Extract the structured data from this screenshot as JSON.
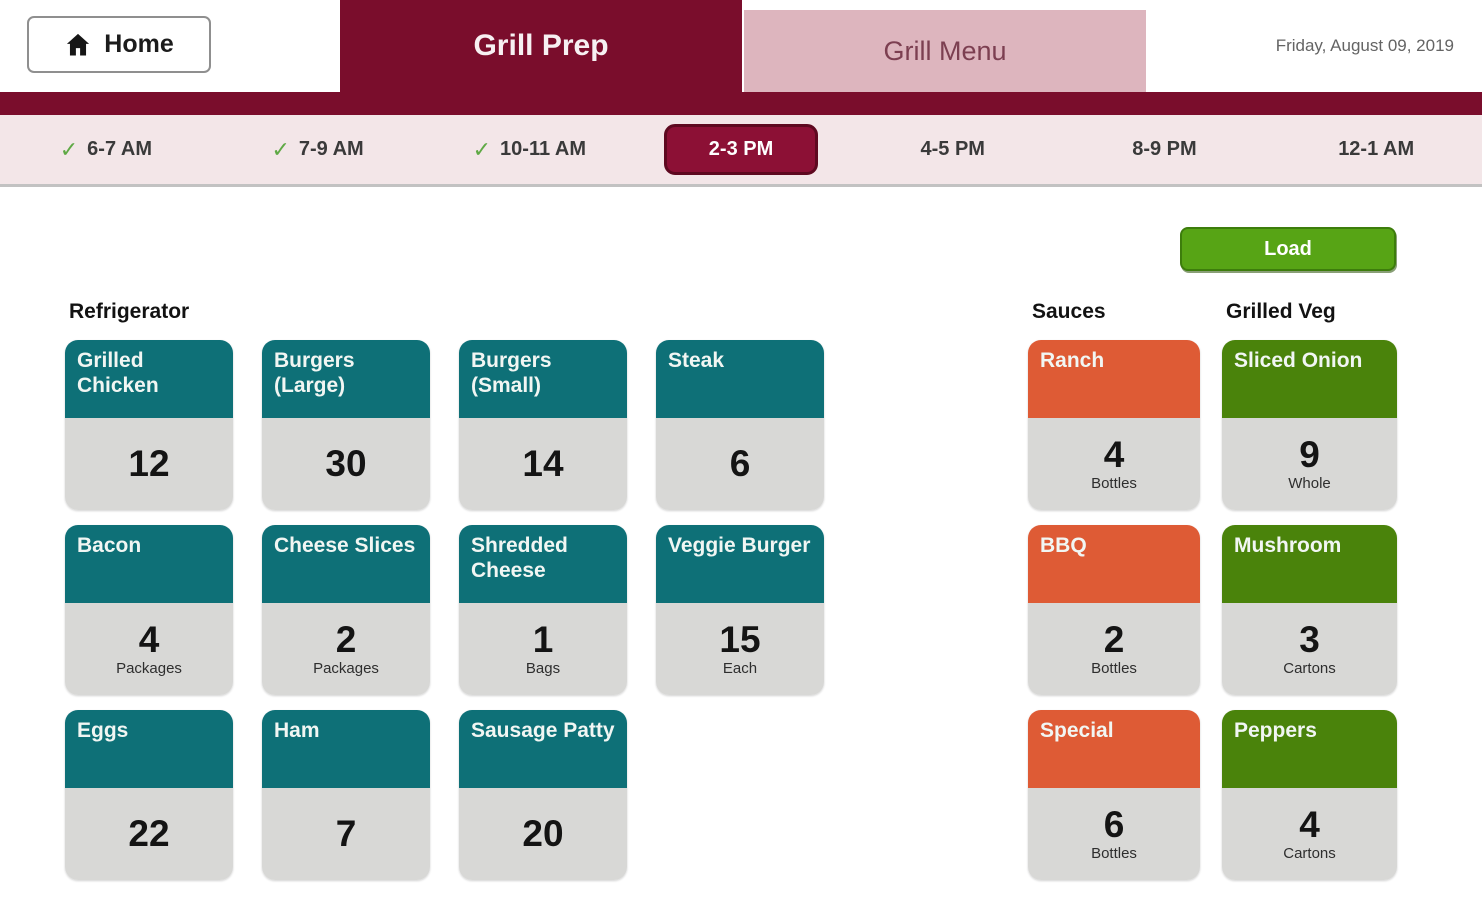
{
  "header": {
    "home_label": "Home",
    "tabs": [
      {
        "label": "Grill Prep",
        "active": true
      },
      {
        "label": "Grill Menu",
        "active": false
      }
    ],
    "date": "Friday, August 09, 2019"
  },
  "icons": {
    "check": "✓"
  },
  "timebar": {
    "slots": [
      {
        "label": "6-7 AM",
        "checked": true,
        "selected": false
      },
      {
        "label": "7-9 AM",
        "checked": true,
        "selected": false
      },
      {
        "label": "10-11 AM",
        "checked": true,
        "selected": false
      },
      {
        "label": "2-3 PM",
        "checked": false,
        "selected": true
      },
      {
        "label": "4-5 PM",
        "checked": false,
        "selected": false
      },
      {
        "label": "8-9 PM",
        "checked": false,
        "selected": false
      },
      {
        "label": "12-1 AM",
        "checked": false,
        "selected": false
      }
    ]
  },
  "load_button_label": "Load",
  "sections": {
    "refrigerator": {
      "title": "Refrigerator",
      "cards": [
        {
          "label": "Grilled Chicken",
          "qty": "12",
          "unit": ""
        },
        {
          "label": "Burgers (Large)",
          "qty": "30",
          "unit": ""
        },
        {
          "label": "Burgers (Small)",
          "qty": "14",
          "unit": ""
        },
        {
          "label": "Steak",
          "qty": "6",
          "unit": ""
        },
        {
          "label": "Bacon",
          "qty": "4",
          "unit": "Packages"
        },
        {
          "label": "Cheese Slices",
          "qty": "2",
          "unit": "Packages"
        },
        {
          "label": "Shredded Cheese",
          "qty": "1",
          "unit": "Bags"
        },
        {
          "label": "Veggie Burger",
          "qty": "15",
          "unit": "Each"
        },
        {
          "label": "Eggs",
          "qty": "22",
          "unit": ""
        },
        {
          "label": "Ham",
          "qty": "7",
          "unit": ""
        },
        {
          "label": "Sausage Patty",
          "qty": "20",
          "unit": ""
        }
      ]
    },
    "sauces": {
      "title": "Sauces",
      "cards": [
        {
          "label": "Ranch",
          "qty": "4",
          "unit": "Bottles"
        },
        {
          "label": "BBQ",
          "qty": "2",
          "unit": "Bottles"
        },
        {
          "label": "Special",
          "qty": "6",
          "unit": "Bottles"
        }
      ]
    },
    "grilled_veg": {
      "title": "Grilled Veg",
      "cards": [
        {
          "label": "Sliced Onion",
          "qty": "9",
          "unit": "Whole"
        },
        {
          "label": "Mushroom",
          "qty": "3",
          "unit": "Cartons"
        },
        {
          "label": "Peppers",
          "qty": "4",
          "unit": "Cartons"
        }
      ]
    }
  },
  "colors": {
    "maroon": "#7A0D2C",
    "selected_pill": "#8C1035",
    "tab_pink": "#DDB5BE",
    "timebar_bg": "#F3E6E8",
    "teal": "#0E7077",
    "orange": "#DE5B35",
    "green": "#4A830B",
    "load_green": "#57A415",
    "card_body_gray": "#D8D8D6",
    "check_green": "#5FA945"
  }
}
